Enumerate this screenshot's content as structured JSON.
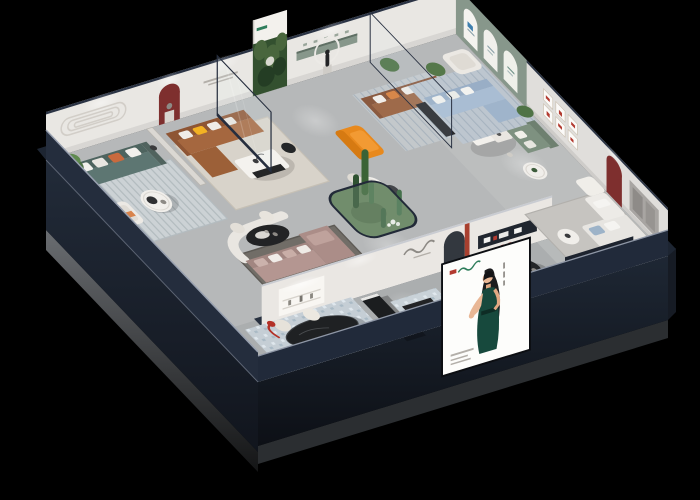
{
  "scene": {
    "description": "3D isometric cutaway render of a furniture showroom floor plan on a black background",
    "view": "axonometric bird's-eye, rotated, roof removed",
    "background_color": "#000000"
  },
  "palette": {
    "navy": "#242d3d",
    "navy_dark": "#1a2230",
    "navy_deep": "#12161e",
    "floor": "#b6b8b9",
    "floor_front": "#abadae",
    "wall_white": "#e9e7e3",
    "wall_gray": "#e0dedb",
    "sage_wall": "#87978b",
    "forest": "#33502f",
    "niche_red": "#7e2f2e",
    "accent_red": "#b23a30",
    "teal_sofa": "#5d7672",
    "brown_sofa": "#a5673f",
    "brown_sofa2": "#9e6a4a",
    "blue_sofa": "#a9bdd3",
    "pink_sofa": "#b49691",
    "orange_chair": "#e8891d",
    "terracotta_sofa": "#c96a4a",
    "bluegray_sofa": "#7d98a4",
    "green_sofa": "#7e9180",
    "white_sofa": "#e7e5e1",
    "rug_cream": "#d8d3ca",
    "rug_blue": "#c5ced5",
    "rug_dark": "#716d67",
    "rug_cool": "#ccd2d5",
    "glass_green": "#5e7d57",
    "poster_dress": "#17493d",
    "poster_skin": "#e9b795",
    "base_concrete": "#686b6f"
  },
  "building": {
    "outer_walls": "dark navy, tall on lower-left, cut low elsewhere",
    "plinth": "gray concrete base fading to black",
    "back_left_wall_features": [
      "capsule relief molding",
      "dark red arched niche with figurine",
      "forest photo mural panel",
      "sage recessed display strip",
      "halo light ring"
    ],
    "back_right_wall_features": [
      "sage green wall with three white arched panels",
      "grid of six small red-accent pictures",
      "dark red arched niche",
      "gray window panel"
    ]
  },
  "rooms": [
    {
      "name": "teal-lounge",
      "furniture": [
        "teal three-seat sofa",
        "striped cool rug",
        "cream armchair",
        "round white coffee table",
        "tall potted plant",
        "floor lamp"
      ]
    },
    {
      "name": "brown-leather-lounge",
      "furniture": [
        "caramel leather sofa with yellow pillow",
        "cream rug",
        "white two-tier coffee table",
        "freestanding framed glass panel"
      ]
    },
    {
      "name": "statue-lounge",
      "furniture": [
        "tan sofa",
        "striped rug",
        "pair of white side tables",
        "orange chaise",
        "round table with dark chairs",
        "figurine with halo ring"
      ]
    },
    {
      "name": "arch-wall-lounge",
      "furniture": [
        "white armchair",
        "light blue sectional sofa",
        "blue striped rug",
        "black console",
        "plant"
      ]
    },
    {
      "name": "gallery-room",
      "furniture": [
        "green loveseat",
        "round white table",
        "plant",
        "floor lamp"
      ]
    },
    {
      "name": "far-right-suite",
      "furniture": [
        "white sectional sofa",
        "gray rug",
        "white side table",
        "black media band with red logo",
        "white daybed"
      ]
    },
    {
      "name": "pink-sectional-room",
      "furniture": [
        "mauve L-sectional with chaise",
        "dark rug",
        "black and white coffee table",
        "curved white partition",
        "black oval table with cream chairs"
      ]
    },
    {
      "name": "cactus-terrarium",
      "furniture": [
        "rounded glass enclosure",
        "mossy green floor",
        "tall cacti",
        "white flower cluster"
      ]
    },
    {
      "name": "front-gallery-strip",
      "furniture": [
        "black oval dining table with four cream chairs",
        "red arc floor lamp",
        "patterned blue rugs",
        "long black display counter",
        "white counter with black top",
        "terracotta sofa in arched nook",
        "blue-gray armchairs with pouf",
        "black round table",
        "white ottoman",
        "lit display alcove",
        "black signage strip with red marks"
      ]
    }
  ],
  "poster": {
    "description": "large white showcase board on front wall with illustrated woman in dark green halter dress, long black hair, gesturing hand",
    "logo": "small red mark with green script logotype, top-left",
    "side_text": "vertical caption dashes beside figure",
    "footer_text": "small gray caption lines, bottom-left"
  }
}
